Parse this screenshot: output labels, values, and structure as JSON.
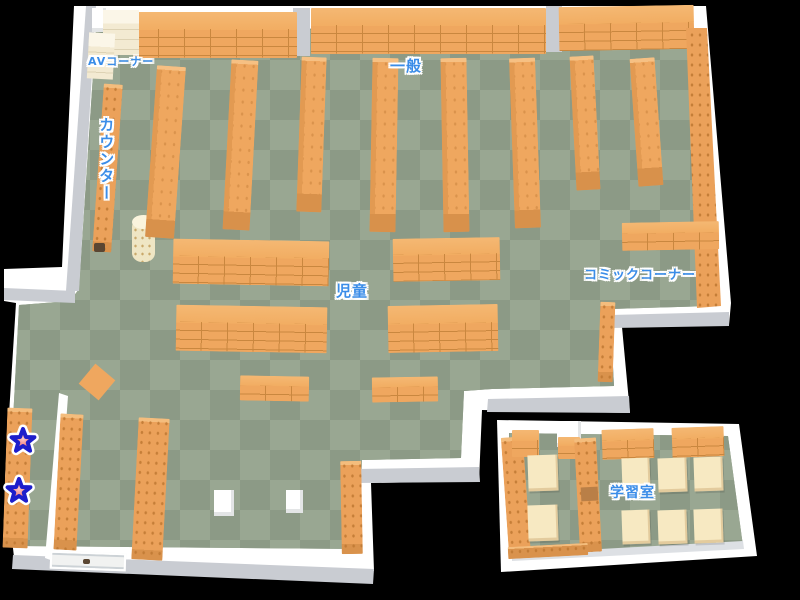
{
  "page": {
    "background": "#000000",
    "width": 800,
    "height": 600
  },
  "map": {
    "name": "library-floor-map",
    "labels": [
      {
        "id": "av-corner",
        "text": "AVコーナー"
      },
      {
        "id": "counter",
        "text": "カウンター"
      },
      {
        "id": "general",
        "text": "一般"
      },
      {
        "id": "children",
        "text": "児童"
      },
      {
        "id": "comic-corner",
        "text": "コミックコーナー"
      },
      {
        "id": "study-room",
        "text": "学習室"
      }
    ],
    "markers": [
      {
        "id": "star-1",
        "shape": "star",
        "fill": "#f28080",
        "outline": "#1d1dcb"
      },
      {
        "id": "star-2",
        "shape": "star",
        "fill": "#f28080",
        "outline": "#1d1dcb"
      }
    ],
    "colors": {
      "floor_light": "#99a792",
      "floor_dark": "#8c9a86",
      "shelf_orange": "#efa75f",
      "shelf_line": "#c9873f",
      "shelf_cream": "#f3ead2",
      "table_cream": "#f7e9c2",
      "wall_white": "#ffffff",
      "wall_gray": "#c9ccd2",
      "label_blue": "#3b8de8"
    }
  }
}
